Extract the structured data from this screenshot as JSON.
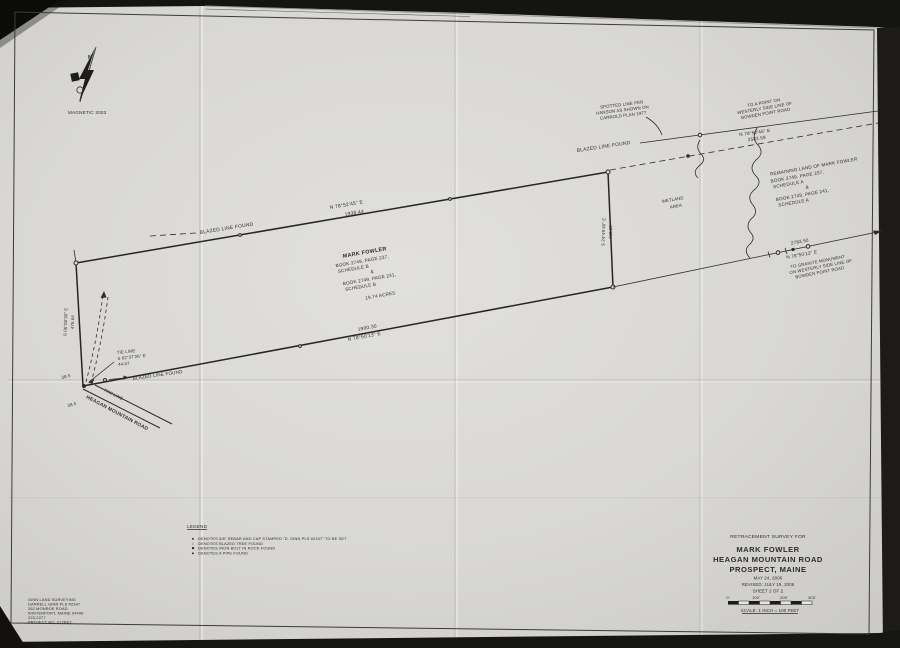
{
  "colors": {
    "paper": "#d9d8d5",
    "ink": "#2e2d2b",
    "scan_background": "#141412"
  },
  "north_arrow": {
    "letter": "N",
    "label": "MAGNETIC 2003"
  },
  "boundaries": {
    "top": {
      "bearing": "N 78°52'45\" E",
      "distance": "1938.44"
    },
    "bottom": {
      "distance": "1900.30",
      "bearing": "N 78°50'13\" E"
    },
    "left": {
      "bearing": "S 06°00'30\" E",
      "distance": "476.64"
    },
    "right": {
      "bearing": "S 24°49'40\" E",
      "distance": "433.39"
    }
  },
  "labels": {
    "blazed_nw": "BLAZED LINE FOUND",
    "blazed_ne": "BLAZED LINE FOUND",
    "blazed_sw": "BLAZED LINE FOUND",
    "rw_line": "R/W LINE",
    "road": "HEAGAN MOUNTAIN ROAD",
    "dim_a": "28.5",
    "dim_b": "28.5"
  },
  "tie_line": {
    "lines": [
      "TIE LINE",
      "S 62°37'26\" E",
      "44.67"
    ]
  },
  "spotted_note": {
    "lines": [
      "SPOTTED LINE PER",
      "HANSON AS SHOWN ON",
      "CARROLD PLAN 1977"
    ]
  },
  "bowden_north": {
    "lines": [
      "TO A POINT ON",
      "WESTERLY SIDE LINE OF",
      "BOWDEN POINT ROAD"
    ],
    "bearing": "N 78°52'45\" E",
    "distance": "2582.59"
  },
  "bowden_south": {
    "distance": "2783.50",
    "bearing": "N 78°50'13\" E",
    "lines": [
      "TO GRANITE MONUMENT",
      "ON WESTERLY SIDE LINE OF",
      "BOWDEN POINT ROAD"
    ]
  },
  "remaining_land": {
    "lines": [
      "REMAINING LAND OF MARK FOWLER",
      "BOOK 2749, PAGE 237,",
      "SCHEDULE A",
      "&",
      "BOOK 2749, PAGE 241,",
      "SCHEDULE A"
    ]
  },
  "wetland": {
    "lines": [
      "WETLAND",
      "AREA"
    ]
  },
  "parcel": {
    "owner": "MARK FOWLER",
    "lines": [
      "BOOK 2749, PAGE 237,",
      "SCHEDULE B",
      "&",
      "BOOK 2749, PAGE 241,",
      "SCHEDULE B"
    ],
    "area": "19.74 ACRES"
  },
  "legend": {
    "title": "LEGEND",
    "items": [
      {
        "symbol": "●",
        "text": "DENOTES 5/8\" REBAR AND CAP STAMPED \"D. GINN PLS #2347\" TO BE SET"
      },
      {
        "symbol": "○",
        "text": "DENOTES BLAZED TREE FOUND"
      },
      {
        "symbol": "■",
        "text": "DENOTES IRON BOLT IN ROCK FOUND"
      },
      {
        "symbol": "●",
        "text": "DENOTES A PIPE FOUND"
      }
    ]
  },
  "title_block": {
    "subtitle": "RETRACEMENT SURVEY FOR",
    "owner": "MARK FOWLER",
    "road": "HEAGAN MOUNTAIN ROAD",
    "town": "PROSPECT, MAINE",
    "date": "MAY 24, 2006",
    "revised": "REVISED:  JULY 19, 2006",
    "sheet": "SHEET 2 OF 2",
    "scale_ticks": [
      "0'",
      "100'",
      "200'",
      "300'"
    ],
    "scale_caption": "SCALE: 1 INCH = 100 FEET"
  },
  "surveyor": {
    "lines": [
      "GINN LAND SURVEYING",
      "DARRELL GINN PLS #2347",
      "262 MONROE ROAD",
      "WINTERPORT, MAINE 04496",
      "223-2277",
      "PROJECT NO. 012BE2"
    ]
  }
}
